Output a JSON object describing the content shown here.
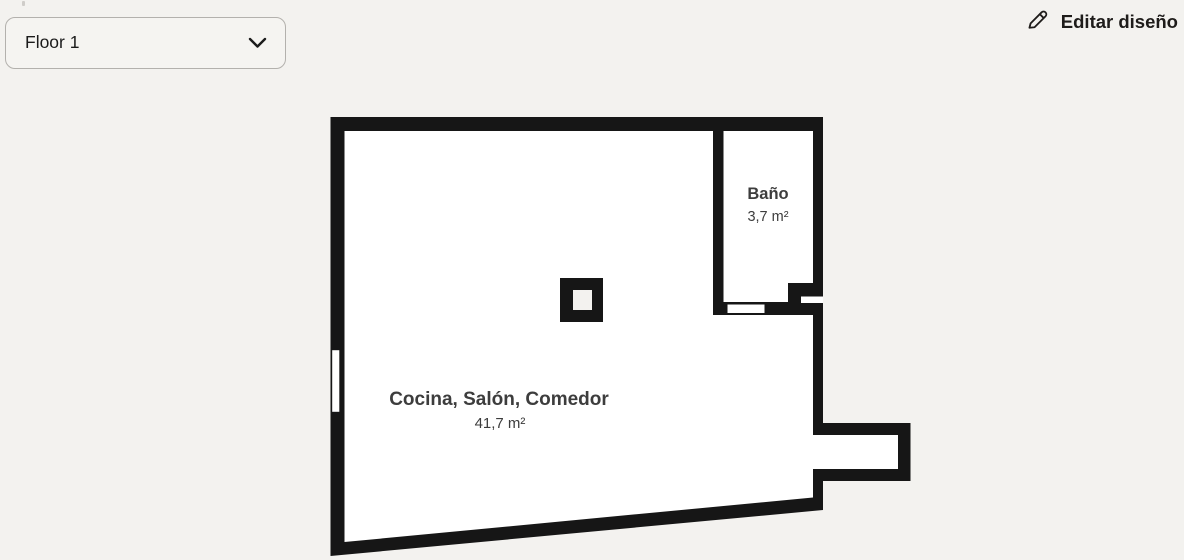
{
  "app": {
    "background": "#f3f2ef"
  },
  "toolbar": {
    "floor_selector": {
      "value": "Floor 1",
      "icon": "chevron-down-icon"
    },
    "edit_button": {
      "label": "Editar diseño",
      "icon": "pencil-icon"
    }
  },
  "floorplan": {
    "colors": {
      "wall": "#161616",
      "room_fill": "#ffffff",
      "opening_fill": "#ffffff",
      "pillar_core_fill": "#f3f2ef",
      "label_text": "#3d3d3d"
    },
    "rooms": [
      {
        "name": "Baño",
        "area": "3,7 m²"
      },
      {
        "name": "Cocina, Salón, Comedor",
        "area": "41,7 m²"
      }
    ]
  }
}
